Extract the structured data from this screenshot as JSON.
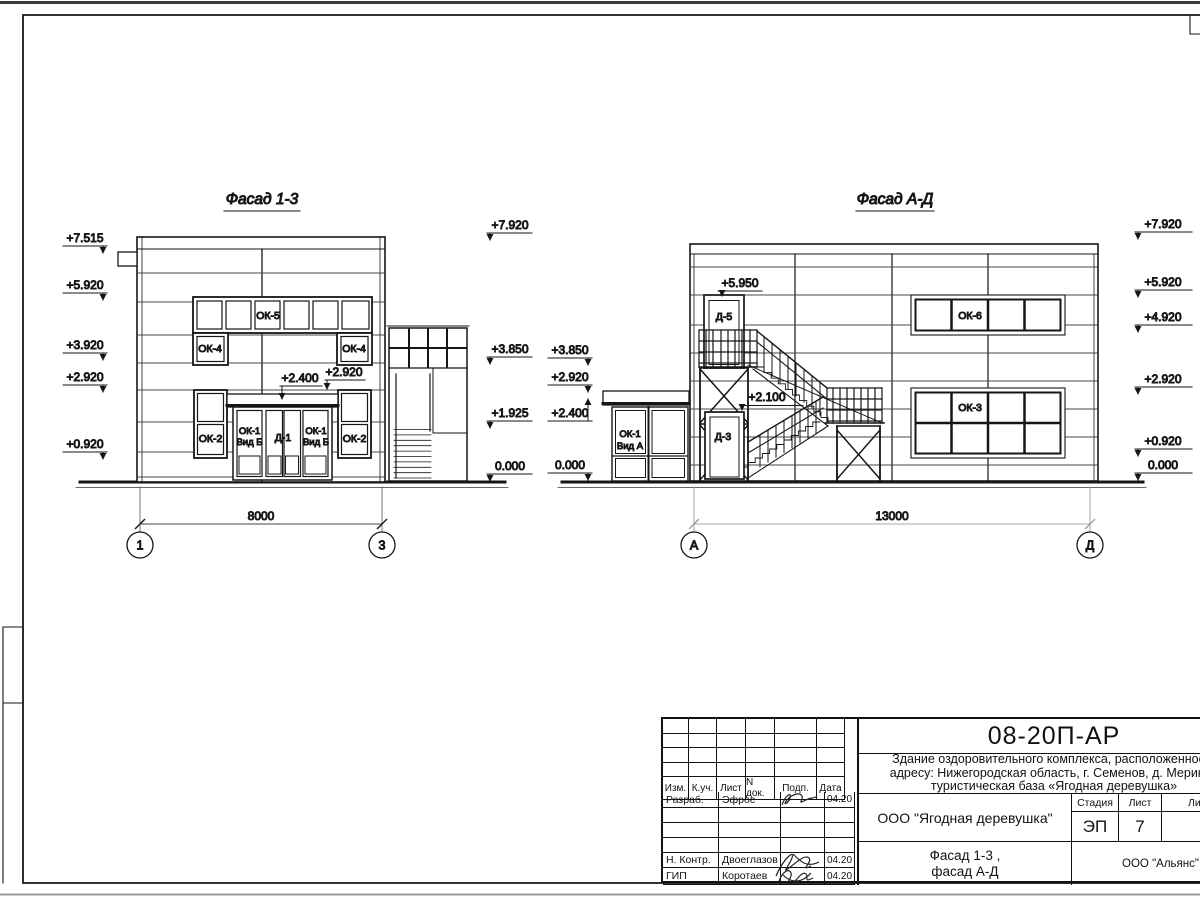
{
  "colors": {
    "line": "#161616",
    "siding": "#4a4a4a",
    "gray": "#999999",
    "bg": "#ffffff"
  },
  "drawing": {
    "facade13": {
      "title": "Фасад 1-3",
      "left_marks": [
        "+7.515",
        "+5.920",
        "+3.920",
        "+2.920",
        "+0.920"
      ],
      "right_marks": [
        "+7.920",
        "+3.850",
        "+1.925",
        "0.000"
      ],
      "canopy_mark_low": "+2.400",
      "canopy_mark_high": "+2.920",
      "labels": {
        "ok5": "ОК-5",
        "ok4": "ОК-4",
        "ok2": "ОК-2",
        "ok1_l1": "ОК-1",
        "ok1_l2": "Вид Б",
        "d1": "Д-1"
      },
      "dimension": "8000",
      "axis_left": "1",
      "axis_right": "3"
    },
    "facadeAD": {
      "title": "Фасад А-Д",
      "left_marks": [
        "+3.850",
        "+2.920",
        "+2.400",
        "0.000"
      ],
      "right_marks": [
        "+7.920",
        "+5.920",
        "+4.920",
        "+2.920",
        "+0.920",
        "0.000"
      ],
      "door_mark_d5": "+5.950",
      "door_mark_d3": "+2.100",
      "labels": {
        "d5": "Д-5",
        "d3": "Д-3",
        "ok6": "ОК-6",
        "ok3": "ОК-3",
        "ok1_l1": "ОК-1",
        "ok1_l2": "Вид А"
      },
      "dimension": "13000",
      "axis_left": "А",
      "axis_right": "Д"
    }
  },
  "titleblock": {
    "doc_code": "08-20П-АР",
    "project_line1": "Здание оздоровительного комплекса, расположенное п",
    "project_line2": "адресу: Нижегородская область, г. Семенов, д. Меринов",
    "project_line3": "туристическая база «Ягодная деревушка»",
    "header_cols": [
      "Изм.",
      "К.уч.",
      "Лист",
      "N док.",
      "Подп.",
      "Дата"
    ],
    "rows": [
      {
        "role": "Разраб.",
        "name": "Эфрос",
        "date": "04.20"
      },
      {
        "role": "",
        "name": "",
        "date": ""
      },
      {
        "role": "",
        "name": "",
        "date": ""
      },
      {
        "role": "",
        "name": "",
        "date": ""
      },
      {
        "role": "Н. Контр.",
        "name": "Двоеглазов",
        "date": "04.20"
      },
      {
        "role": "ГИП",
        "name": "Коротаев",
        "date": "04.20"
      }
    ],
    "client": "ООО \"Ягодная деревушка\"",
    "stage_label": "Стадия",
    "stage_value": "ЭП",
    "sheet_label": "Лист",
    "sheet_value": "7",
    "sheets_label": "Листов",
    "title_line1": "Фасад 1-3 ,",
    "title_line2": "фасад А-Д",
    "contractor": "ООО \"Альянс\""
  }
}
